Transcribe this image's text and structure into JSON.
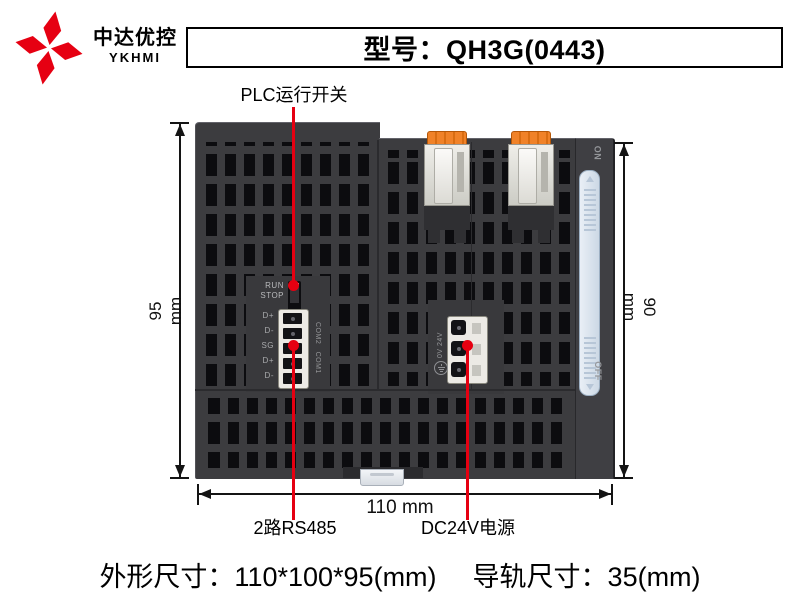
{
  "brand": {
    "name_cn": "中达优控",
    "name_en": "YKHMI"
  },
  "header": {
    "model_label": "型号：QH3G(0443)"
  },
  "callouts": {
    "plc_switch": "PLC运行开关",
    "rs485": "2路RS485",
    "power": "DC24V电源"
  },
  "dimensions": {
    "height_left": "95 mm",
    "height_right": "90 mm",
    "width_bottom": "110 mm"
  },
  "device": {
    "run": "RUN",
    "stop": "STOP",
    "rs485_pins": [
      "D+",
      "D-",
      "SG",
      "D+",
      "D-"
    ],
    "com_groups": [
      "COM2",
      "COM1"
    ],
    "power_label": "0V 24V",
    "rail_on": "ON",
    "rail_off": "OFF"
  },
  "footer": {
    "outline": "外形尺寸：110*100*95(mm)",
    "rail": "导轨尺寸：35(mm)"
  },
  "colors": {
    "brand_red": "#e60012",
    "callout_red": "#e60011",
    "body_gray": "#3c3c3f",
    "vent_black": "#0c0c0f",
    "clip_orange": "#ef7b22",
    "terminal_cream": "#eceae5",
    "slider_blue": "#dde7f2",
    "dim_line": "#141414"
  }
}
